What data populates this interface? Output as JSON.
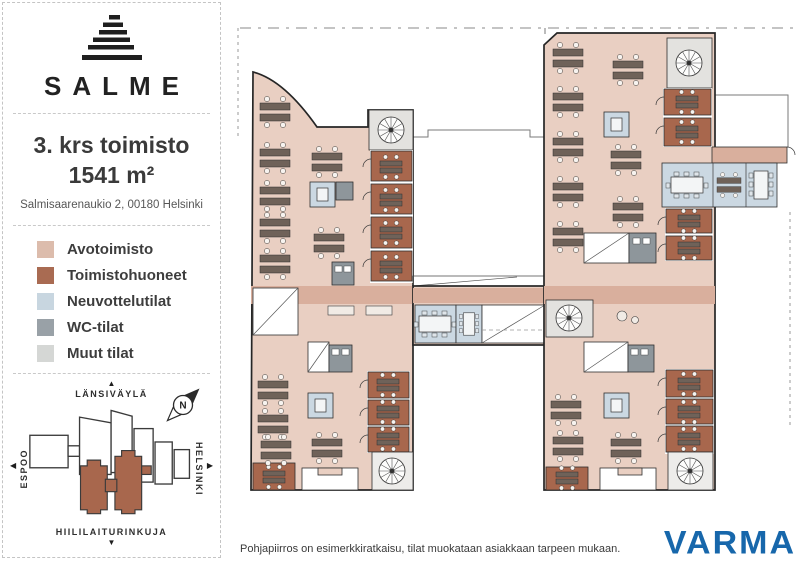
{
  "sidebar": {
    "logo_text": "SALME",
    "title_line1": "3. krs toimisto",
    "title_line2": "1541 m²",
    "address": "Salmisaarenaukio 2, 00180 Helsinki",
    "legend": {
      "items": [
        {
          "label": "Avotoimisto",
          "color": "#dcbcac"
        },
        {
          "label": "Toimistohuoneet",
          "color": "#a96b52"
        },
        {
          "label": "Neuvottelutilat",
          "color": "#c8d6e0"
        },
        {
          "label": "WC-tilat",
          "color": "#99a1a7"
        },
        {
          "label": "Muut tilat",
          "color": "#d5d7d5"
        }
      ]
    },
    "map": {
      "north_label": "LÄNSIVÄYLÄ",
      "south_label": "HIILILAITURINKUJA",
      "west_label": "ESPOO",
      "east_label": "HELSINKI",
      "compass": "N",
      "highlight_color": "#a8674d"
    }
  },
  "icons": {
    "up": "▲",
    "down": "▼",
    "left": "◀",
    "right": "▶"
  },
  "footer": {
    "disclaimer": "Pohjapiirros on esimerkkiratkaisu, tilat muokataan asiakkaan tarpeen mukaan.",
    "brand": "VARMA",
    "brand_color": "#1767ab"
  }
}
